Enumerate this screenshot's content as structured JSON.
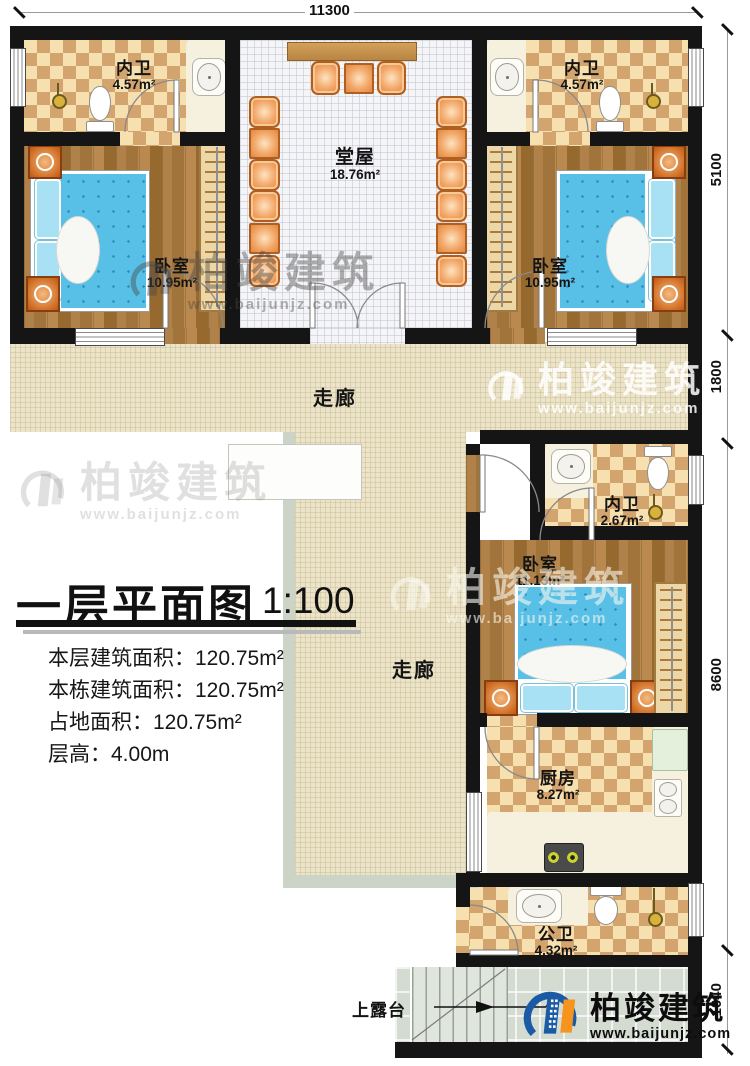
{
  "dims": {
    "top": "11300",
    "right": [
      "5100",
      "1800",
      "8600",
      "1040"
    ]
  },
  "rooms": {
    "bath_left": {
      "name": "内卫",
      "area": "4.57m²"
    },
    "bath_right": {
      "name": "内卫",
      "area": "4.57m²"
    },
    "hall": {
      "name": "堂屋",
      "area": "18.76m²"
    },
    "bedroom_left": {
      "name": "卧室",
      "area": "10.95m²"
    },
    "bedroom_right": {
      "name": "卧室",
      "area": "10.95m²"
    },
    "corridor_h": {
      "name": "走廊"
    },
    "corridor_v": {
      "name": "走廊"
    },
    "bath_mid": {
      "name": "内卫",
      "area": "2.67m²"
    },
    "bedroom_bottom": {
      "name": "卧室",
      "area": "11.13m²"
    },
    "kitchen": {
      "name": "厨房",
      "area": "8.27m²"
    },
    "bath_public": {
      "name": "公卫",
      "area": "4.32m²"
    },
    "terrace": {
      "name": "上露台"
    }
  },
  "title_block": {
    "title": "一层平面图",
    "scale": "1:100",
    "lines": [
      "本层建筑面积：120.75m²",
      "本栋建筑面积：120.75m²",
      "占地面积：120.75m²",
      "层高：4.00m"
    ]
  },
  "watermark": {
    "brand": "柏竣建筑",
    "url": "www.baijunjz.com"
  },
  "logo": {
    "brand": "柏竣建筑",
    "url": "www.baijunjz.com"
  },
  "colors": {
    "logo_blue": "#1b5aa5",
    "logo_orange": "#f7941d",
    "wall": "#151515"
  }
}
